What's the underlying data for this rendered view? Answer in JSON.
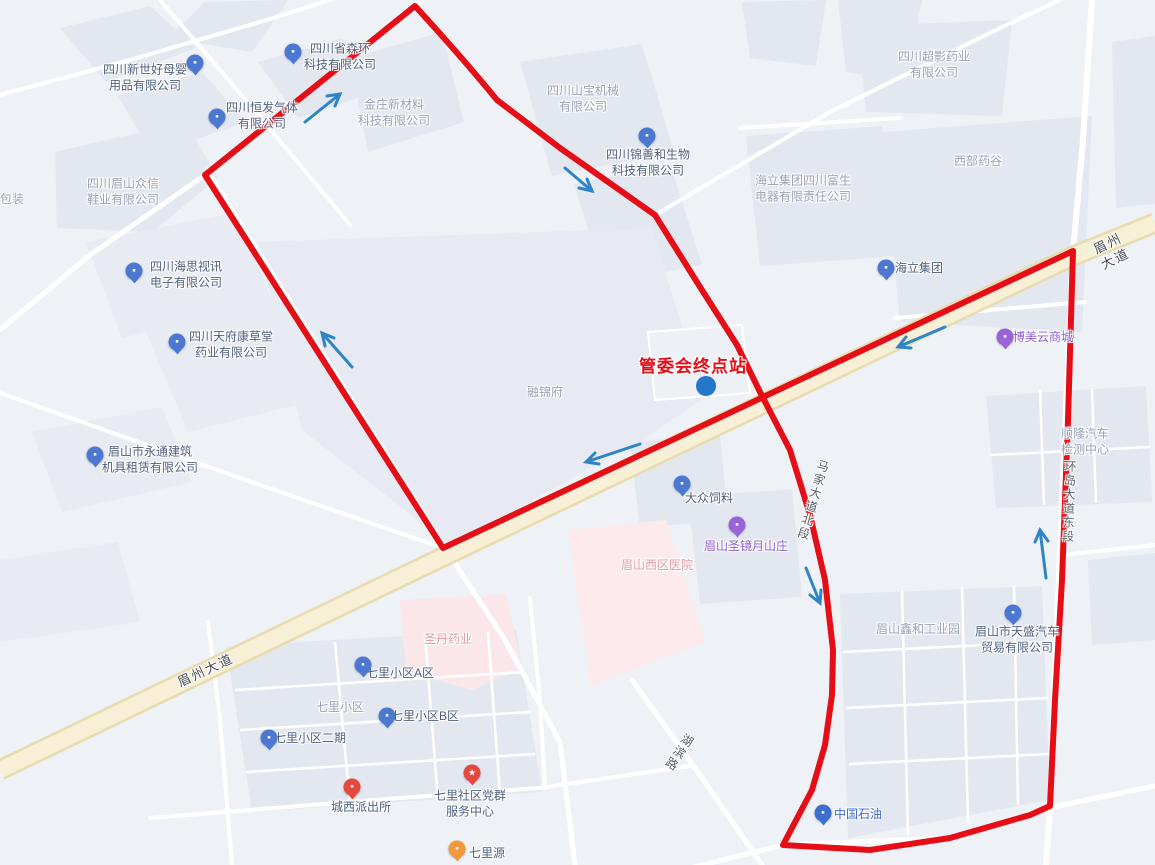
{
  "annotation": {
    "terminal": "管委会终点站"
  },
  "icons": {
    "building": "▪",
    "star": "★",
    "car": "▪",
    "bed": "▪",
    "mall": "▪",
    "fuel": "▪",
    "food": "▪",
    "police": "▪"
  },
  "colors": {
    "route_red": "#e50e17",
    "arrow_blue": "#2e85c6",
    "marker_blue": "#2577cc",
    "road_cream": "#f7efd6"
  },
  "roads": {
    "meizhou": "眉州大道",
    "majia_north": "马家大道北段",
    "huandao_east": "环岛大道东段",
    "hubin": "湖滨路"
  },
  "pois": {
    "xinshihao": "四川新世好母婴\n用品有限公司",
    "senhuan": "四川省森环\n科技有限公司",
    "hengfa": "四川恒发气体\n有限公司",
    "jinzhuang": "金庄新材料\n科技有限公司",
    "zhongxin": "四川眉山众信\n鞋业有限公司",
    "baozhuang": "包装",
    "shanbao": "四川山宝机械\n有限公司",
    "jinshanhe": "四川锦善和生物\n科技有限公司",
    "chaoying": "四川超影药业\n有限公司",
    "xibuyaogu": "西部药谷",
    "fusheng": "海立集团四川富生\n电器有限责任公司",
    "haili": "海立集团",
    "haisi": "四川海思视讯\n电子有限公司",
    "kangcaotang": "四川天府康草堂\n药业有限公司",
    "yongtong": "眉山市永通建筑\n机具租赁有限公司",
    "bomei": "博美云商城",
    "rongjinfu": "融锦府",
    "shunlong": "顺隆汽车\n检测中心",
    "dazhong": "大众饲料",
    "shengjing": "眉山圣镜月山庄",
    "xiqu_hospital": "眉山西区医院",
    "shengdan": "圣丹药业",
    "xinhe": "眉山鑫和工业园",
    "tiansheng": "眉山市天盛汽车\n贸易有限公司",
    "qili_a": "七里小区A区",
    "qili": "七里小区",
    "qili_b": "七里小区B区",
    "qili_erqi": "七里小区二期",
    "chengxi_police": "城西派出所",
    "dangqun": "七里社区党群\n服务中心",
    "qiliyuan": "七里源",
    "petrochina": "中国石油"
  }
}
